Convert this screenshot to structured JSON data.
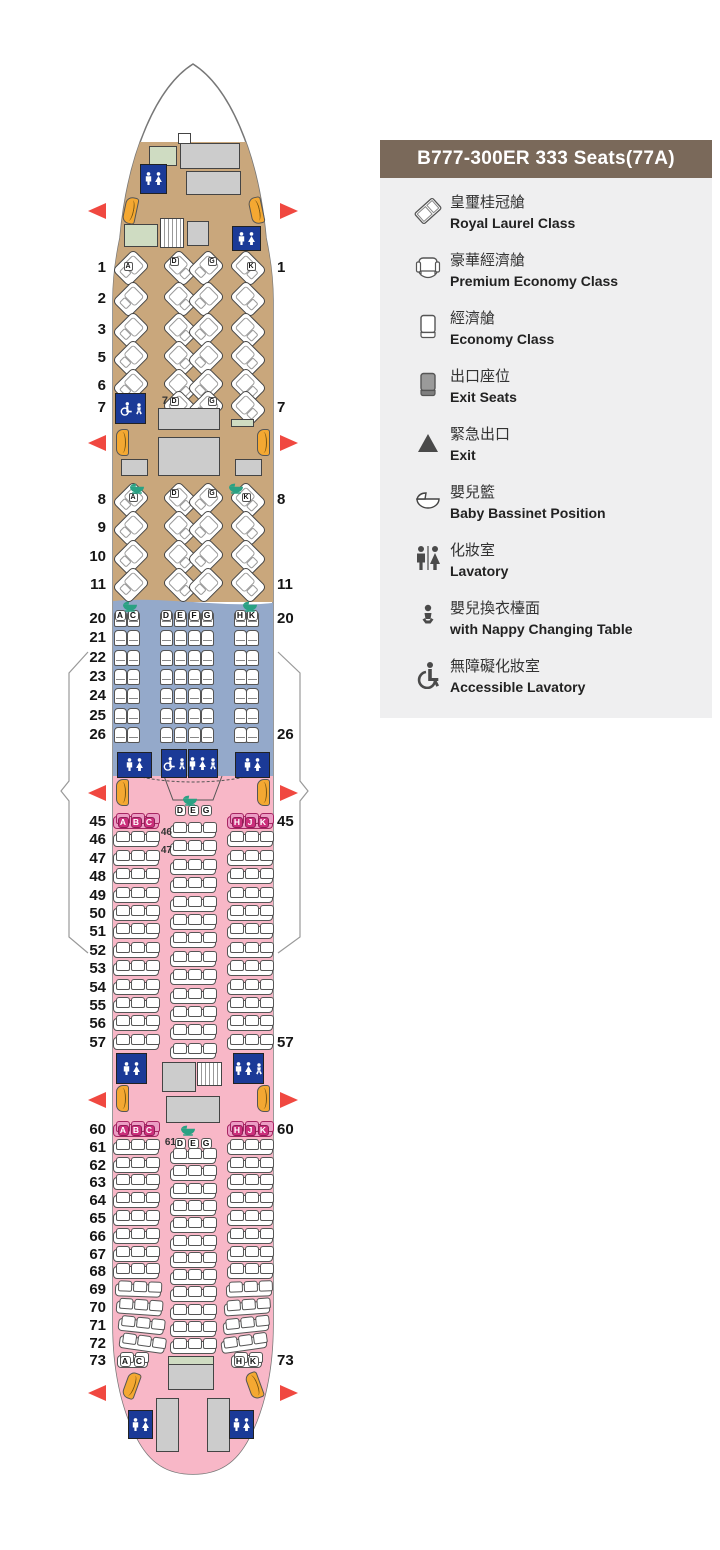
{
  "legend": {
    "title": "B777-300ER 333 Seats(77A)",
    "items": [
      {
        "icon": "royal-laurel-seat-icon",
        "zh": "皇璽桂冠艙",
        "en": "Royal Laurel Class"
      },
      {
        "icon": "premium-economy-seat-icon",
        "zh": "豪華經濟艙",
        "en": "Premium Economy Class"
      },
      {
        "icon": "economy-seat-icon",
        "zh": "經濟艙",
        "en": "Economy Class"
      },
      {
        "icon": "exit-seat-icon",
        "zh": "出口座位",
        "en": "Exit Seats"
      },
      {
        "icon": "exit-triangle-icon",
        "zh": "緊急出口",
        "en": "Exit"
      },
      {
        "icon": "bassinet-icon",
        "zh": "嬰兒籃",
        "en": "Baby Bassinet Position"
      },
      {
        "icon": "lavatory-icon",
        "zh": "化妝室",
        "en": "Lavatory"
      },
      {
        "icon": "nappy-changing-icon",
        "zh": "嬰兒換衣檯面",
        "en": "with Nappy Changing Table"
      },
      {
        "icon": "accessible-lavatory-icon",
        "zh": "無障礙化妝室",
        "en": "Accessible Lavatory"
      }
    ]
  },
  "seatmap": {
    "royal_laurel": {
      "cabin1_rows": [
        "1",
        "2",
        "3",
        "5",
        "6",
        "7"
      ],
      "cabin2_rows": [
        "8",
        "9",
        "10",
        "11"
      ],
      "row1_letters": [
        "A",
        "D",
        "G",
        "K"
      ],
      "row7_letters": [
        "D",
        "G"
      ],
      "row7_label": "7",
      "row8_letters": [
        "A",
        "D",
        "G",
        "K"
      ]
    },
    "premium_economy": {
      "rows": [
        "20",
        "21",
        "22",
        "23",
        "24",
        "25",
        "26"
      ],
      "letters": [
        "A",
        "C",
        "D",
        "E",
        "F",
        "G",
        "H",
        "K"
      ]
    },
    "economy_forward": {
      "side_rows": [
        "45",
        "46",
        "47",
        "48",
        "49",
        "50",
        "51",
        "52",
        "53",
        "54",
        "55",
        "56",
        "57"
      ],
      "center_rows_count": 13,
      "exit_row_letters_left": [
        "A",
        "B",
        "C"
      ],
      "exit_row_letters_right": [
        "H",
        "J",
        "K"
      ],
      "center_header_letters": [
        "D",
        "E",
        "G"
      ],
      "center_row_labels": [
        "46",
        "47"
      ]
    },
    "economy_aft": {
      "side_rows": [
        "60",
        "61",
        "62",
        "63",
        "64",
        "65",
        "66",
        "67",
        "68",
        "69",
        "70",
        "71",
        "72",
        "73"
      ],
      "center_rows_count": 12,
      "exit_row_letters_left": [
        "A",
        "B",
        "C"
      ],
      "exit_row_letters_right": [
        "H",
        "J",
        "K"
      ],
      "center_header_letters": [
        "D",
        "E",
        "G"
      ],
      "center_row_label": "61",
      "last_row_letters_left": [
        "A",
        "C"
      ],
      "last_row_letters_right": [
        "H",
        "K"
      ]
    },
    "right_side_row_labels": [
      "1",
      "7",
      "8",
      "11",
      "20",
      "26",
      "45",
      "57",
      "60",
      "73"
    ]
  },
  "colors": {
    "royal_laurel_cabin": "#c9a77c",
    "premium_economy_cabin": "#94a9ca",
    "economy_cabin": "#f8b7c7",
    "exit_row_letter": "#cb2f7b",
    "lavatory": "#1b3a97",
    "door": "#f4a832",
    "exit_arrow": "#f04840",
    "bassinet": "#2aa183",
    "legend_header": "#7a695a",
    "legend_background": "#efeff0"
  }
}
